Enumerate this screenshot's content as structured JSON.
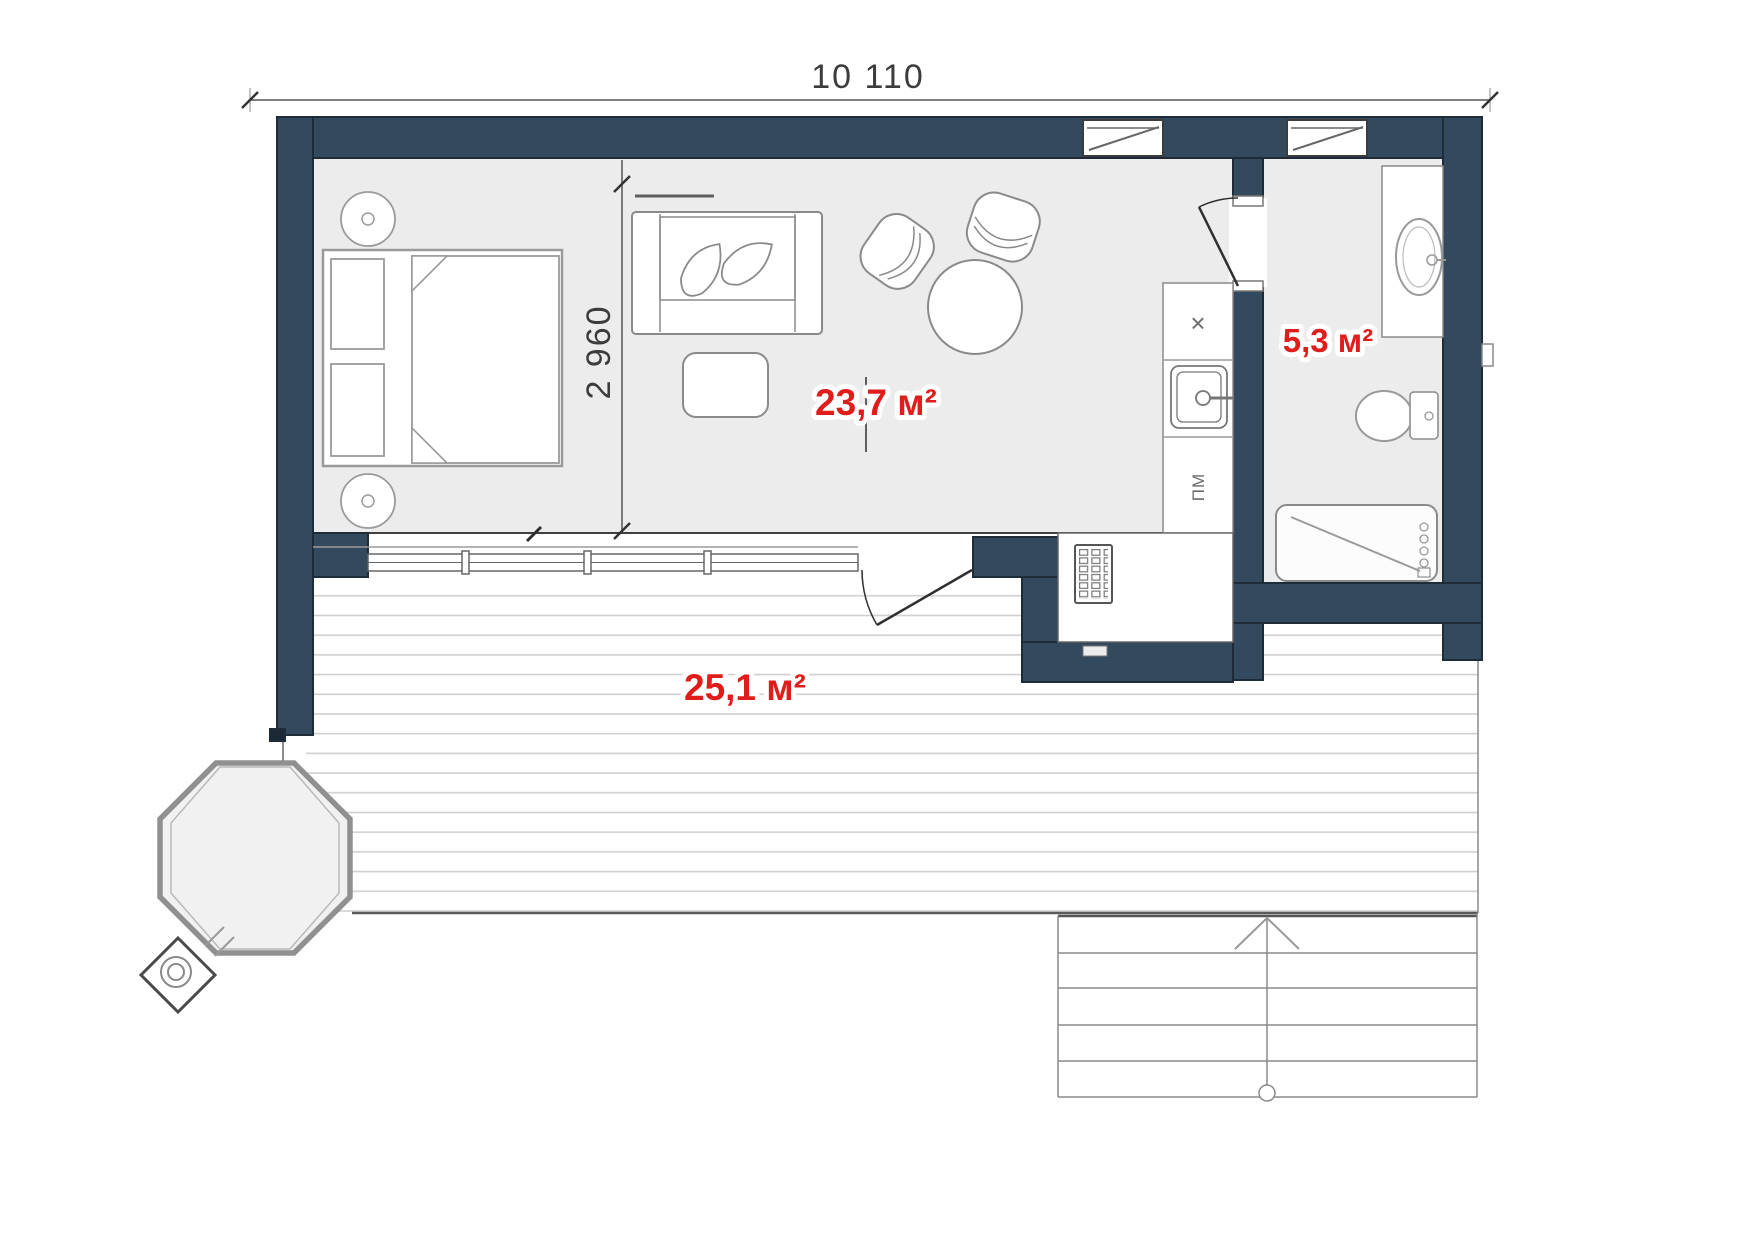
{
  "title": "studio-house-floor-plan",
  "dimensions": {
    "overall_width": "10 110",
    "room_depth": "2 960"
  },
  "areas": {
    "living": "23,7 м²",
    "bathroom": "5,3 м²",
    "terrace": "25,1 м²"
  },
  "kitchen": {
    "hob_symbol": "×",
    "dishwasher_label": "ПМ"
  },
  "colors": {
    "wall": "#334a5e",
    "label": "#df1e1c",
    "floor": "#ececec"
  }
}
